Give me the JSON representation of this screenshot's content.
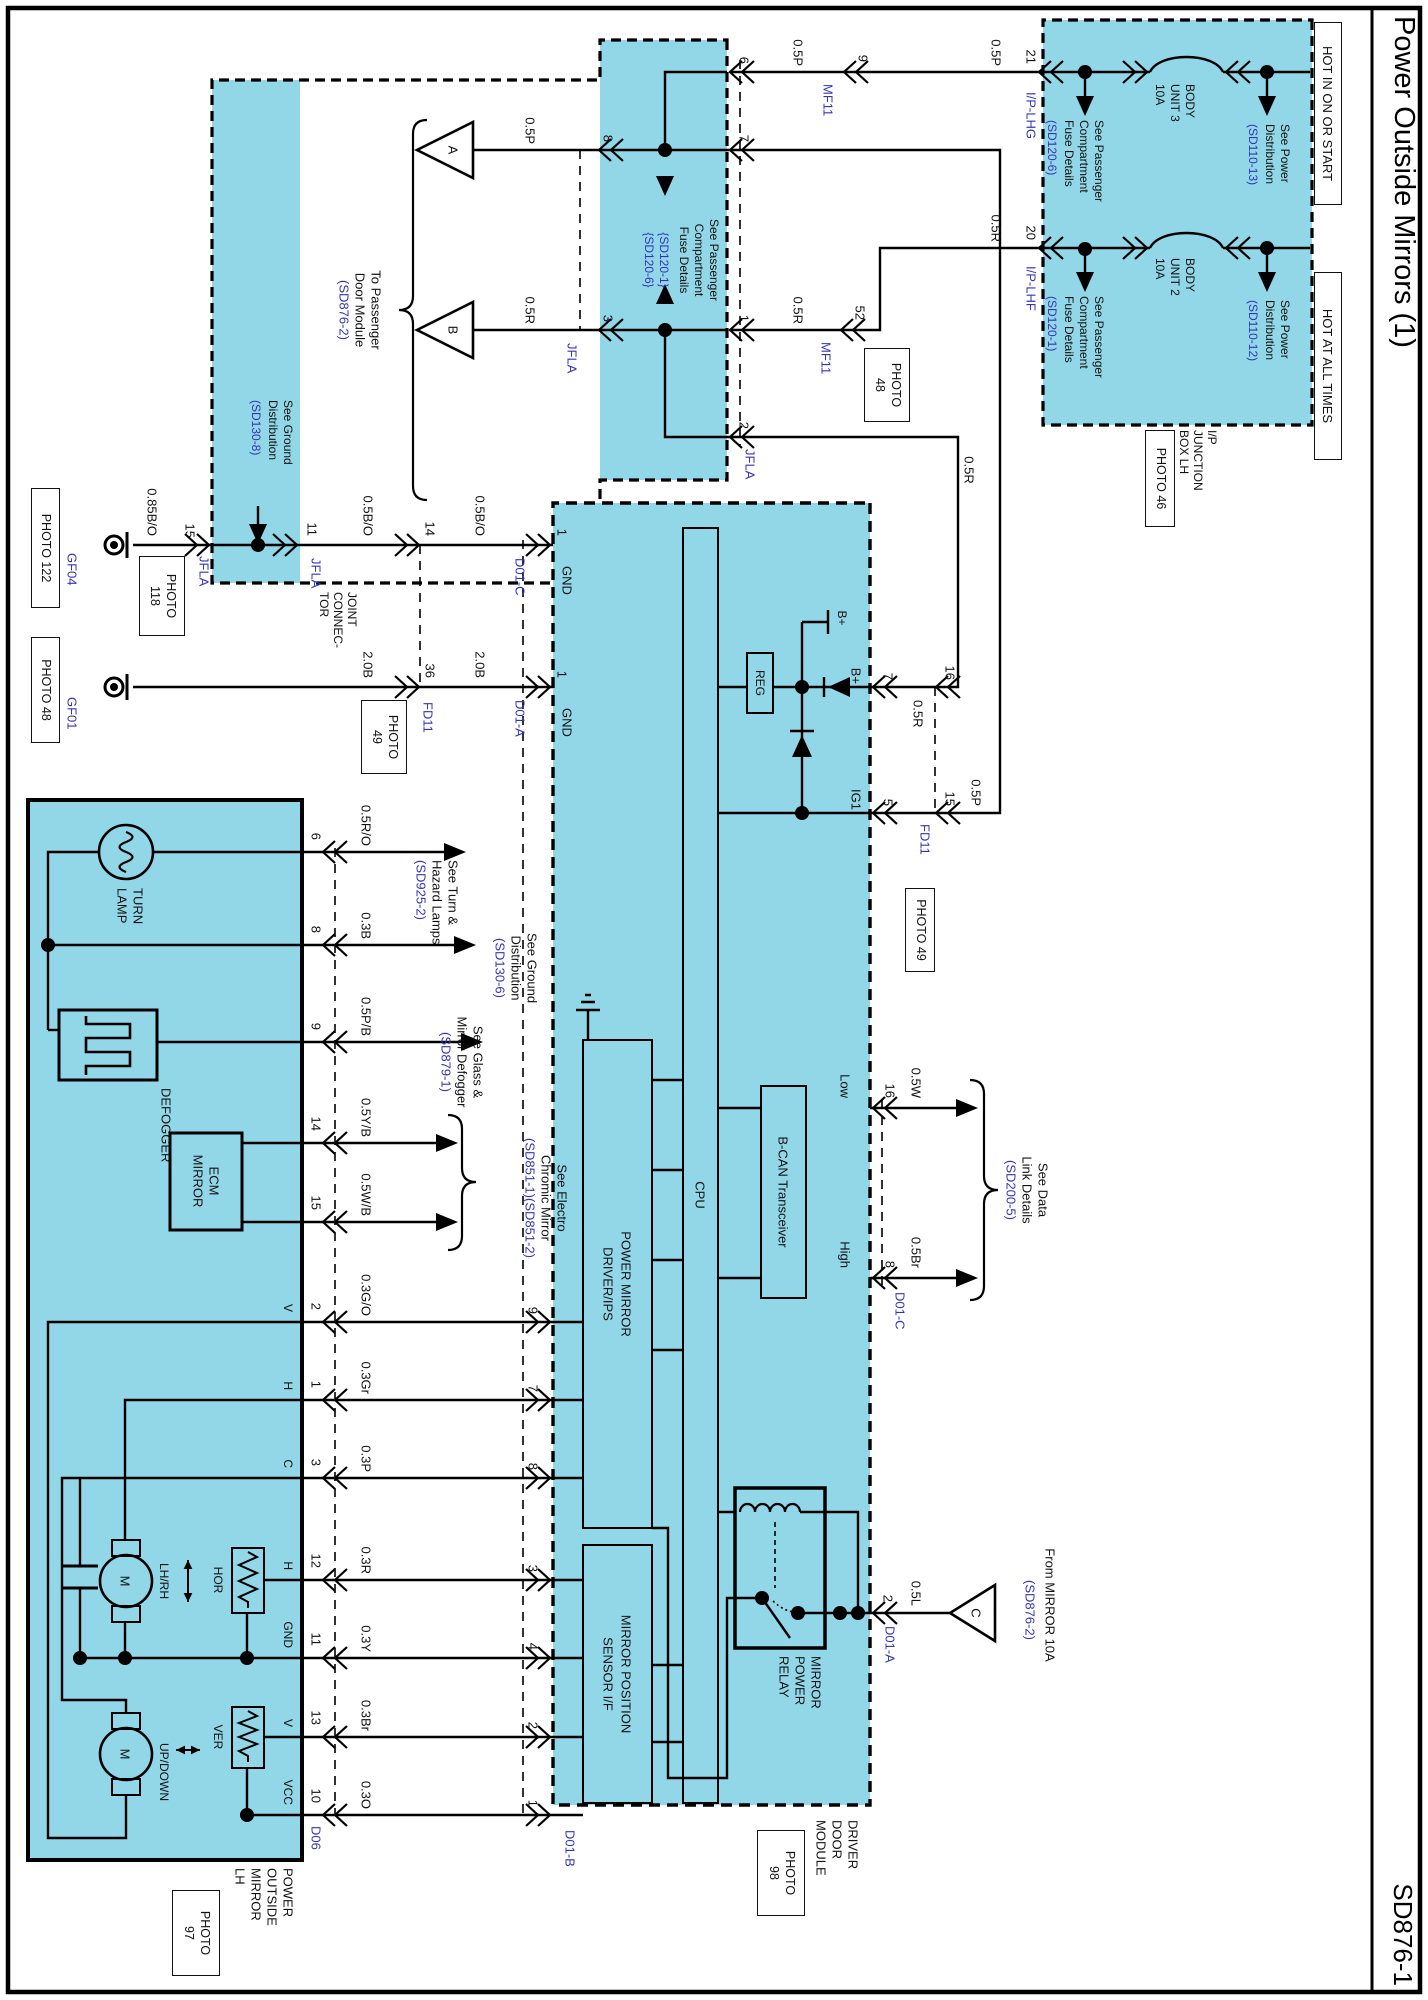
{
  "title": "Power Outside Mirrors (1)",
  "code": "SD876-1",
  "colors": {
    "cyan": "#92d7e7",
    "blue": "#3333bb",
    "line": "#000000"
  },
  "fuse": {
    "hot1": "HOT IN ON OR START",
    "hot2": "HOT AT ALL TIMES",
    "sp1": [
      "See Power",
      "Distribution",
      "(SD110-13)"
    ],
    "sp2": [
      "See Power",
      "Distribution",
      "(SD110-12)"
    ],
    "f1": [
      "BODY",
      "UNIT 3",
      "10A"
    ],
    "f2": [
      "BODY",
      "UNIT 2",
      "10A"
    ],
    "sf1": [
      "See Passenger",
      "Compartment",
      "Fuse Details",
      "(SD120-6)"
    ],
    "sf2": [
      "See Passenger",
      "Compartment",
      "Fuse Details",
      "(SD120-1)"
    ],
    "p21": "21",
    "p20": "20",
    "lhg": "I/P-LHG",
    "lhf": "I/P-LHF",
    "ip": [
      "I/P",
      "JUNCTION",
      "BOX LH"
    ],
    "photo46": "PHOTO 46"
  },
  "mf": {
    "n": "MF11",
    "p9": "9",
    "p52": "52",
    "photo48": [
      "PHOTO",
      "48"
    ]
  },
  "band": {
    "t": [
      "See Passenger",
      "Compartment",
      "Fuse Details",
      "{SD120-1}",
      "{SD120-6}"
    ],
    "p6": "6",
    "p7": "7",
    "p1": "1",
    "p2": "2",
    "p8": "8",
    "p3": "3",
    "jfla": "JFLA"
  },
  "tri": {
    "a": "A",
    "b": "B",
    "c": "C",
    "pdm": [
      "To Passenger",
      "Door Module",
      "(SD876-2)"
    ],
    "from": [
      "From MIRROR 10A",
      "(SD876-2)"
    ]
  },
  "gband": {
    "t": [
      "See Ground",
      "Distribution",
      "(SD130-8)"
    ]
  },
  "g1": {
    "gf": "GF04",
    "ph": "PHOTO 122",
    "w0": "0.85B/O",
    "p15": "15",
    "jfla": "JFLA",
    "ph118": [
      "PHOTO",
      "118"
    ],
    "p11": "11",
    "jc": [
      "JOINT",
      "CONNEC-",
      "TOR"
    ],
    "w1": "0.5B/O",
    "p14": "14",
    "w2": "0.5B/O",
    "p1": "1",
    "d": "D01-C",
    "gnd": "GND"
  },
  "g2": {
    "gf": "GF01",
    "ph": "PHOTO 48",
    "w1": "2.0B",
    "p36": "36",
    "fd": "FD11",
    "ph49": [
      "PHOTO",
      "49"
    ],
    "w2": "2.0B",
    "p1": "1",
    "d": "D01-A",
    "gnd": "GND"
  },
  "pw": {
    "w1": "0.5R",
    "p16": "16",
    "p7": "7",
    "bp": "B+",
    "bat": "B+",
    "reg": "REG",
    "w2": "0.5P",
    "p15": "15",
    "p5": "5",
    "fd": "FD11",
    "ph49": "PHOTO 49",
    "ig": "IG1"
  },
  "can": {
    "low": "Low",
    "high": "High",
    "wl": "0.5W",
    "wh": "0.5Br",
    "p16": "16",
    "p8": "8",
    "d": "D01-C",
    "see": [
      "See Data",
      "Link Details",
      "(SD200-5)"
    ],
    "bcan": "B-CAN Transceiver"
  },
  "ddm": {
    "cpu": "CPU",
    "drv": [
      "POWER MIRROR",
      "DRIVER/IPS"
    ],
    "mps": [
      "MIRROR POSITION",
      "SENSOR I/F"
    ],
    "rly": [
      "MIRROR",
      "POWER",
      "RELAY"
    ],
    "p2": "2",
    "d": "D01-A",
    "w": "0.5L",
    "lbl": [
      "DRIVER",
      "DOOR",
      "MODULE"
    ],
    "ph": [
      "PHOTO",
      "98"
    ],
    "db": "D01-B"
  },
  "mir": {
    "lbl": [
      "POWER",
      "OUTSIDE",
      "MIRROR",
      "LH"
    ],
    "ph": [
      "PHOTO",
      "97"
    ],
    "turn": [
      "TURN",
      "LAMP"
    ],
    "def": "DEFOGGER",
    "ecm": [
      "ECM",
      "MIRROR"
    ],
    "lr": "LH/RH",
    "ud": "UP/DOWN",
    "hor": "HOR",
    "ver": "VER",
    "m": "M",
    "d06": "D06",
    "pins": {
      "p6": "6",
      "p8": "8",
      "p9": "9",
      "p14": "14",
      "p15": "15",
      "p2": "2",
      "p1": "1",
      "p3": "3",
      "p12": "12",
      "p11": "11",
      "p13": "13",
      "p10": "10"
    },
    "nm": {
      "v": "V",
      "h": "H",
      "c": "C",
      "h2": "H",
      "gnd": "GND",
      "v2": "V",
      "vcc": "VCC"
    }
  },
  "dp": {
    "p9": "9",
    "p7": "7",
    "p8": "8",
    "p3": "3",
    "p4": "4",
    "p2": "2",
    "p1": "1"
  },
  "w": {
    "f1a": "0.5P",
    "f1b": "0.5P",
    "f2a": "0.5R",
    "f2b": "0.5R",
    "a": "0.5P",
    "b": "0.5R",
    "v": "0.3G/O",
    "h": "0.3Gr",
    "c": "0.3P",
    "hs": "0.3R",
    "gn": "0.3Y",
    "vs": "0.3Br",
    "vcc": "0.3O",
    "tn": "0.5R/O",
    "tg": "0.3B",
    "df": "0.5P/B",
    "e1": "0.5Y/B",
    "e2": "0.5W/B"
  },
  "see": {
    "turn": [
      "See Turn &",
      "Hazard Lamps",
      "(SD925-2)"
    ],
    "gnd": [
      "See Ground",
      "Distribution",
      "(SD130-6)"
    ],
    "def": [
      "See Glass &",
      "Mirror Defogger",
      "(SD879-1)"
    ],
    "ecm": [
      "See Electro",
      "Chromic Mirror",
      "(SD851-1)(SD851-2)"
    ]
  }
}
